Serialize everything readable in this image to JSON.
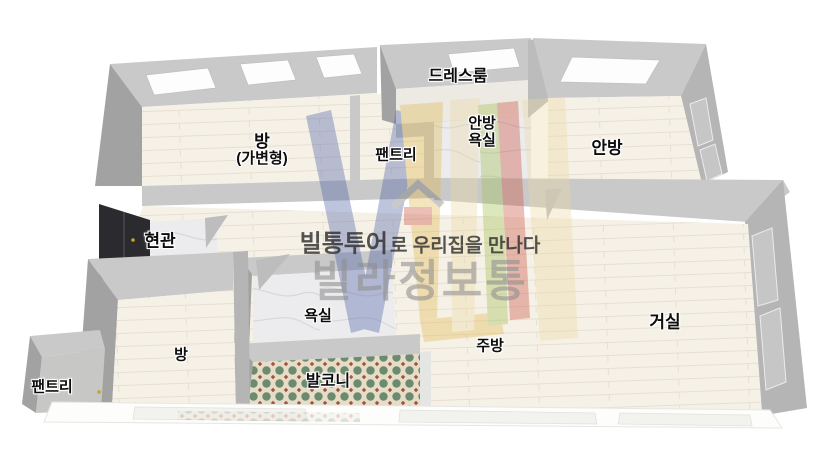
{
  "rooms": {
    "dress_room": "드레스룸",
    "room_convertible_line1": "방",
    "room_convertible_line2": "(가변형)",
    "pantry_top": "팬트리",
    "master_bath_line1": "안방",
    "master_bath_line2": "욕실",
    "master_bedroom": "안방",
    "entrance": "현관",
    "bathroom": "욕실",
    "living_room": "거실",
    "kitchen": "주방",
    "room_small": "방",
    "balcony": "발코니",
    "pantry_bottom": "팬트리"
  },
  "watermark": {
    "brand_bold": "빌통투어",
    "tagline_rest": "로 우리집을 만나다",
    "brand_large": "빌라정보통"
  },
  "colors": {
    "wall": "#c9c9c9",
    "wall_dark": "#a2a2a2",
    "floor": "#f6f1e7",
    "marble": "#ececee",
    "door": "#2b2b2f",
    "tile_bg": "#e6ddc9",
    "tile_green": "#6b8a6e",
    "tile_red": "#a2543a",
    "logo_blue": "#4a5fa5",
    "logo_yellow": "#e0b84e",
    "logo_cream": "#ecd9a4",
    "logo_green": "#9fbf4e",
    "logo_red": "#c94e3e"
  }
}
